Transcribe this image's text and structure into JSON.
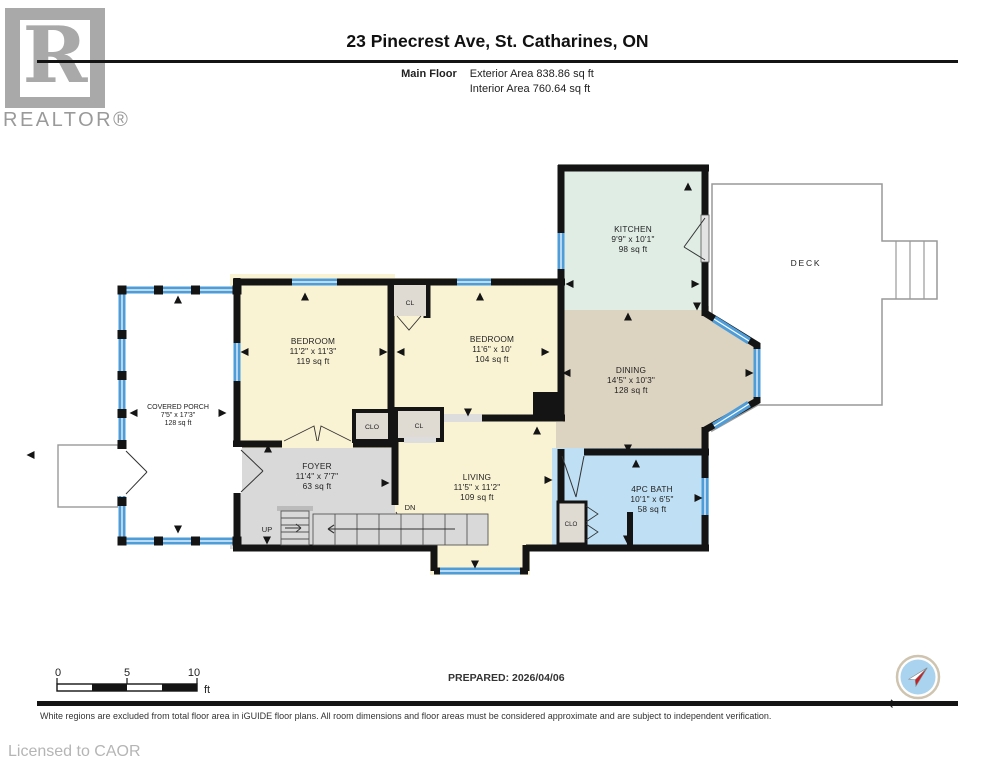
{
  "header": {
    "logo_word": "REALTOR®",
    "logo_r": "R",
    "title": "23 Pinecrest Ave, St. Catharines, ON",
    "floor_label": "Main Floor",
    "exterior_area": "Exterior Area 838.86 sq ft",
    "interior_area": "Interior Area 760.64 sq ft"
  },
  "plan": {
    "rooms": {
      "kitchen": {
        "name": "KITCHEN",
        "dims": "9'9\" x 10'1\"",
        "area": "98 sq ft"
      },
      "bedroom1": {
        "name": "BEDROOM",
        "dims": "11'2\" x 11'3\"",
        "area": "119 sq ft"
      },
      "bedroom2": {
        "name": "BEDROOM",
        "dims": "11'6\" x 10'",
        "area": "104 sq ft"
      },
      "dining": {
        "name": "DINING",
        "dims": "14'5\" x 10'3\"",
        "area": "128 sq ft"
      },
      "living": {
        "name": "LIVING",
        "dims": "11'5\" x 11'2\"",
        "area": "109 sq ft"
      },
      "foyer": {
        "name": "FOYER",
        "dims": "11'4\" x 7'7\"",
        "area": "63 sq ft"
      },
      "bath": {
        "name": "4PC BATH",
        "dims": "10'1\" x 6'5\"",
        "area": "58 sq ft"
      },
      "porch": {
        "name": "COVERED PORCH",
        "dims": "7'5\" x 17'3\"",
        "area": "128 sq ft"
      },
      "deck": {
        "name": "DECK"
      }
    },
    "labels": {
      "cl": "CL",
      "clo": "CLO",
      "up": "UP",
      "down": "DN"
    }
  },
  "scalebar": {
    "t0": "0",
    "t5": "5",
    "t10": "10",
    "unit": "ft"
  },
  "footer": {
    "prepared": "PREPARED: 2026/04/06",
    "compass_n": "N",
    "disclaimer": "White regions are excluded from total floor area in iGUIDE floor plans. All room dimensions and floor areas must be considered approximate and are subject to independent verification.",
    "license": "Licensed to CAOR"
  },
  "colors": {
    "wall": "#141414",
    "window_blue": "#4E9CD8",
    "cream": "#FAF3D3",
    "mint": "#DFEDE5",
    "tan": "#DDD3C1",
    "bath_blue": "#BEDFF4",
    "foyer_gray": "#D9D9D9",
    "closet_gray": "#DFDAD2"
  }
}
